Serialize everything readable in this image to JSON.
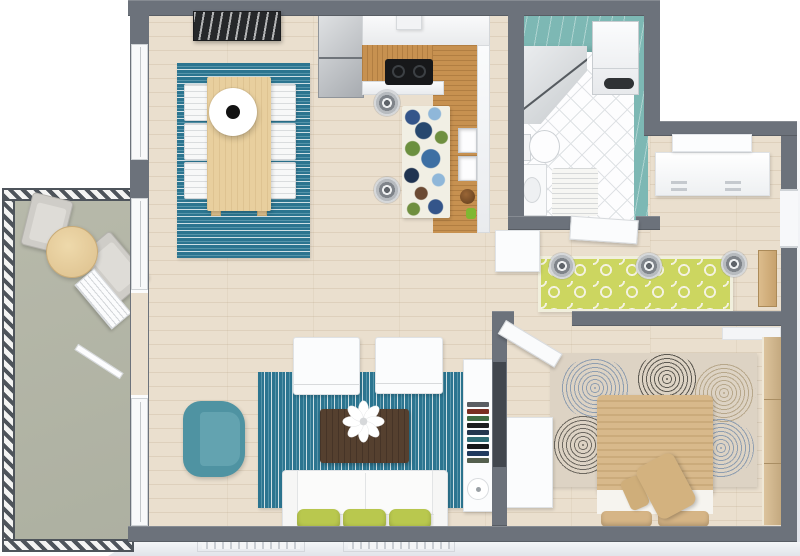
{
  "scene": {
    "type": "3d-floor-plan-top-view",
    "style": "photoreal-apartment-render",
    "background": "#ffffff"
  },
  "colors": {
    "wall": "#6c727b",
    "floor_wood": "#eadfce",
    "balcony_floor": "#b2b4a5",
    "rail_dark": "#4e545b",
    "tile_teal": "#7db8b4",
    "bath_floor": "#fdfdfe",
    "rug_teal_dark": "#2c7590",
    "rug_teal_light": "#5795aa",
    "rug_lime": "#ccd660",
    "rug_bedroom_base": "#ddd3c4",
    "counter_wood": "#c79150",
    "table_wood_light": "#e8cf9e",
    "coffee_table_wood": "#55402f",
    "armchair_teal": "#4f93a2",
    "pillow_green": "#b9c84e",
    "bed_tan": "#d8b98b",
    "wardrobe_wood": "#d0b58c",
    "steel": "#b9bdc2",
    "cooktop_black": "#17181a",
    "tv_dark": "#42474e",
    "ledge": "#eef0f4"
  },
  "rooms": {
    "balcony": {
      "items": [
        "hatched-railing",
        "bistro-table",
        "patio-chair",
        "patio-chair",
        "louvered-door-panel",
        "glass-door-panel"
      ]
    },
    "dining_area": {
      "items": [
        "wall-art",
        "striped-teal-rug",
        "dining-table",
        "dining-chairs-x6",
        "round-pendant-lamp"
      ]
    },
    "kitchen": {
      "items": [
        "fridge-freezer",
        "upper-cabinets",
        "range-hood",
        "cooktop",
        "l-shaped-wood-counter",
        "double-sink",
        "floral-rug",
        "pendant-lights-x2",
        "bowl",
        "plant"
      ]
    },
    "bathroom": {
      "items": [
        "corner-shower",
        "washing-machine",
        "toilet",
        "vanity-sink",
        "bath-mat",
        "teal-wall-tiles",
        "open-door"
      ]
    },
    "hallway": {
      "items": [
        "quatrefoil-lime-rug",
        "pendant-lights-x3",
        "sideboard",
        "ceiling-light-panel",
        "entry-doorway",
        "entry-door-panel",
        "console-cabinet"
      ]
    },
    "living_room": {
      "items": [
        "striped-teal-rug",
        "sofa",
        "green-pillows-x3",
        "white-armchair-x2",
        "coffee-table",
        "flower-decor",
        "teal-armchair",
        "tv-console",
        "book-stack",
        "round-speaker",
        "wall-tv"
      ]
    },
    "bedroom": {
      "items": [
        "swirl-pattern-rug",
        "double-bed",
        "pillows-x2",
        "cushions-x2",
        "desk",
        "wardrobe",
        "closet-shelf",
        "open-door"
      ]
    }
  },
  "tv_console": {
    "book_spines": [
      "#5a5e63",
      "#7a2e22",
      "#3f6b43",
      "#1c1d1f",
      "#24364e",
      "#2e6b74",
      "#17181a",
      "#203a5e",
      "#55604f"
    ]
  },
  "counts": {
    "dining_chairs": 6,
    "kitchen_pendants": 2,
    "hall_pendants": 3,
    "sofa_pillows": 3,
    "floor_vents": 2
  }
}
